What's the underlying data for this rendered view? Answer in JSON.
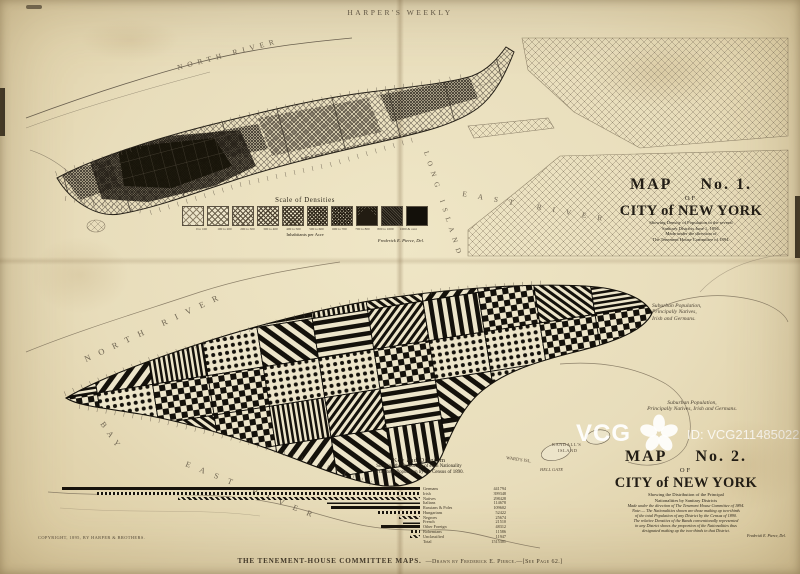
{
  "page": {
    "masthead": "HARPER'S WEEKLY",
    "copyright": "COPYRIGHT, 1895, BY HARPER & BROTHERS.",
    "caption_main": "THE TENEMENT-HOUSE COMMITTEE MAPS.",
    "caption_credit": "—Drawn by Frederick E. Pierce.—[See Page 62.]"
  },
  "map1": {
    "title_map": "MAP",
    "title_no": "No. 1.",
    "title_of": "OF",
    "title_city": "CITY of NEW YORK",
    "subtitle_lines": [
      "Showing Density of Population in the several",
      "Sanitary Districts June 1, 1894.",
      "Made under the direction of",
      "The Tenement House Committee of 1894."
    ],
    "legend": {
      "title": "Scale of Densities",
      "unit_label": "Inhabitants per Acre",
      "credit": "Frederick E. Pierce, Del.",
      "bins": [
        "0 to 100",
        "100 to 200",
        "200 to 300",
        "300 to 400",
        "400 to 500",
        "500 to 600",
        "600 to 700",
        "700 to 800",
        "800 to 1000",
        "1000 & over"
      ]
    },
    "water": {
      "north_river": "NORTH RIVER",
      "east_river": "EAST RIVER",
      "long_island": "LONG ISLAND"
    }
  },
  "map2": {
    "title_map": "MAP",
    "title_no": "No. 2.",
    "title_of": "OF",
    "title_city": "CITY of NEW YORK",
    "subtitle_lines": [
      "Showing the Distribution of the Principal",
      "Nationalities by Sanitary Districts"
    ],
    "note_lines": [
      "Made under the direction of The Tenement House Committee of 1894.",
      "Note:— The Nationalities shown are those making up two-thirds",
      "of the total Population of any District by the Census of 1890.",
      "The relative Densities of the Bands conventionally represented",
      "in any District shows the proportion of the Nationalities thus",
      "designated making up the two-thirds in that District."
    ],
    "credit": "Frederick E. Pierce, Del.",
    "water": {
      "north_river": "NORTH RIVER",
      "bay": "BAY",
      "east_river": "EAST RIVER",
      "randalls_line1": "RANDALL'S",
      "randalls_line2": "ISLAND",
      "wards": "WARD'S ISL.",
      "hell_gate": "HELL GATE"
    },
    "suburban_note_1": [
      "Suburban Population,",
      "Principally Natives,",
      "Irish and Germans."
    ],
    "suburban_note_2": [
      "Suburban Population,",
      "Principally Natives, Irish and Germans."
    ]
  },
  "key_diagram": {
    "title_lines": [
      "Key and Diagram",
      "Showing the Proportion of each Nationality",
      "in the total Population by the Census of 1890."
    ]
  },
  "chart_data": {
    "type": "bar",
    "orientation": "horizontal",
    "title": "Key and Diagram — Proportion of each Nationality in the total Population, Census of 1890",
    "categories": [
      "Germans",
      "Irish",
      "Natives",
      "Italians",
      "Russians & Poles",
      "Hungarians",
      "Negroes",
      "French",
      "Other Foreign",
      "Bohemians",
      "Unclassified"
    ],
    "values": [
      441794,
      399348,
      298428,
      114678,
      109602,
      52422,
      25674,
      21510,
      48312,
      11586,
      11947
    ],
    "total_label": "Total",
    "total_value": "1515301",
    "xlabel": "",
    "ylabel": "",
    "legend_position": "right"
  },
  "watermark": {
    "brand": "VCG",
    "id_text": "ID: VCG211485022655"
  }
}
